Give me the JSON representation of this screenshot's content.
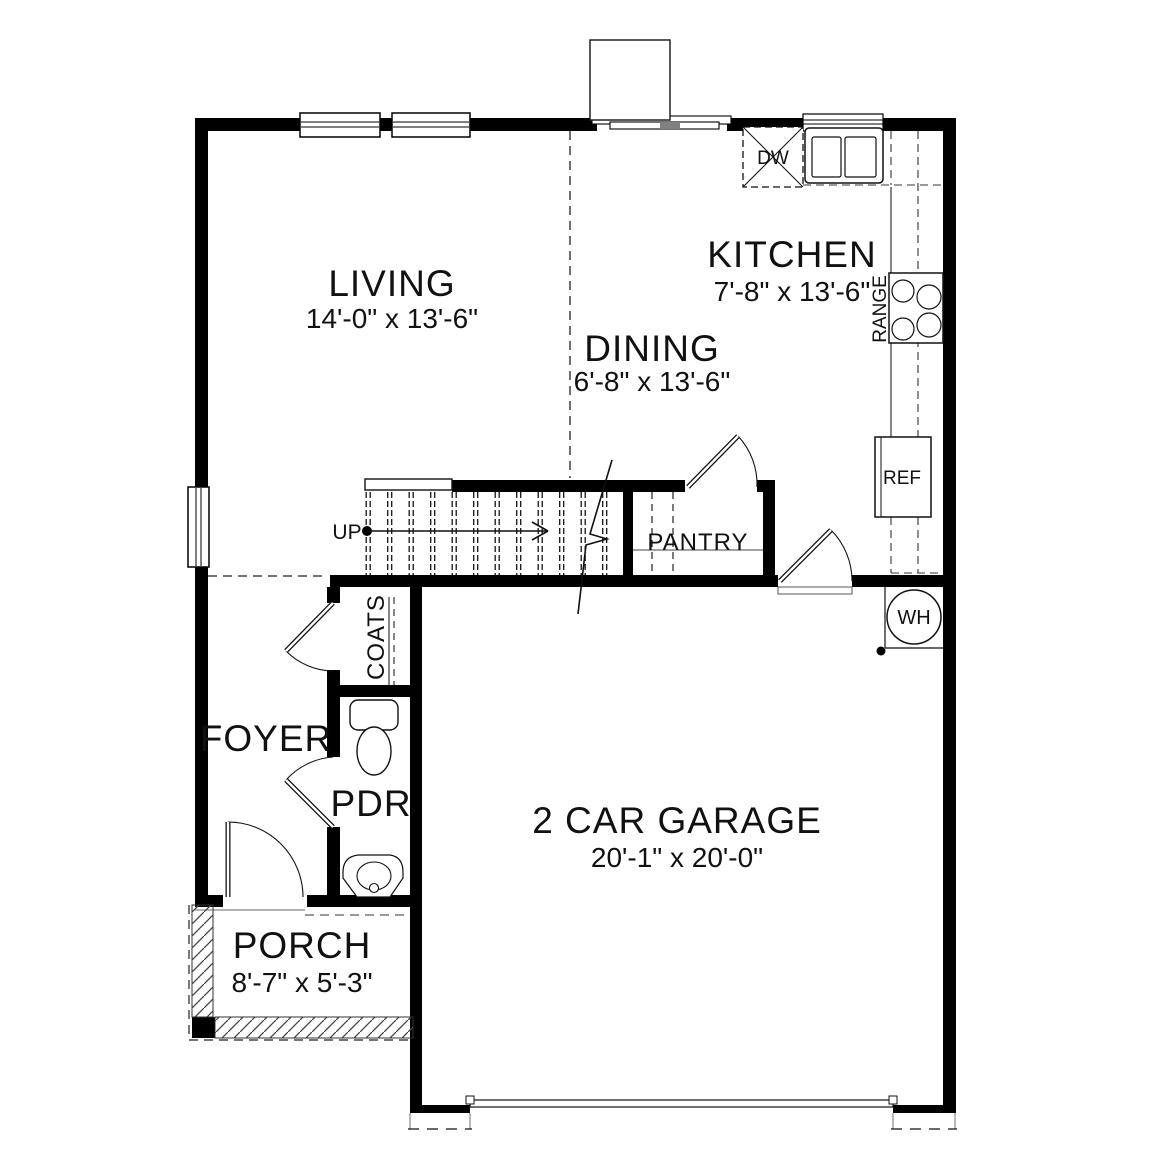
{
  "rooms": {
    "living": {
      "label": "LIVING",
      "dims": "14'-0\" x 13'-6\""
    },
    "dining": {
      "label": "DINING",
      "dims": "6'-8\" x 13'-6\""
    },
    "kitchen": {
      "label": "KITCHEN",
      "dims": "7'-8\" x 13'-6\""
    },
    "garage": {
      "label": "2 CAR GARAGE",
      "dims": "20'-1\" x 20'-0\""
    },
    "porch": {
      "label": "PORCH",
      "dims": "8'-7\" x 5'-3\""
    },
    "foyer": {
      "label": "FOYER"
    },
    "powder_room": {
      "label": "PDR"
    },
    "pantry": {
      "label": "PANTRY"
    },
    "coats_closet": {
      "label": "COATS"
    }
  },
  "annotations": {
    "stairs_direction": "UP"
  },
  "appliances": {
    "dishwasher": "DW",
    "range": "RANGE",
    "refrigerator": "REF",
    "water_heater": "WH"
  },
  "colors": {
    "wall": "#000000",
    "thin_line": "#1a1a1a",
    "background": "#ffffff"
  }
}
